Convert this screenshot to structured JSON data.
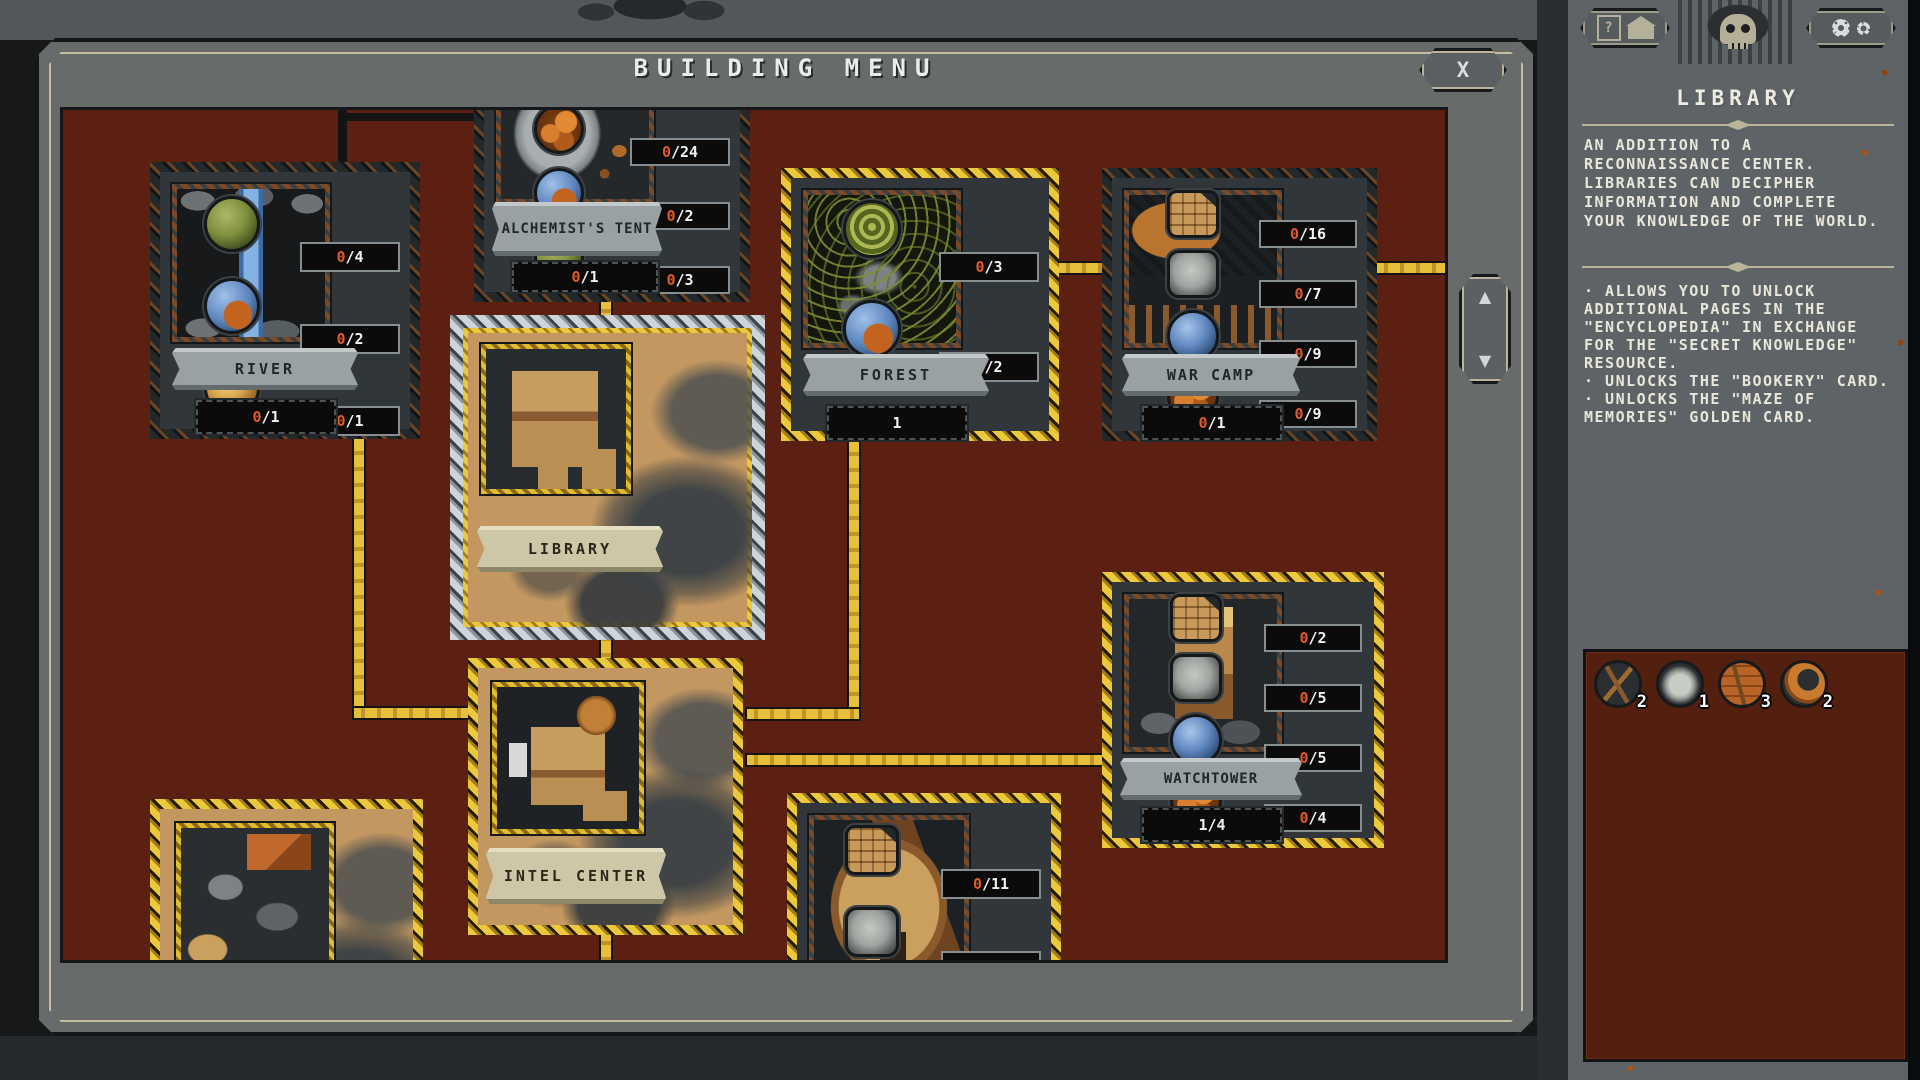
{
  "window": {
    "title": "BUILDING MENU",
    "close_icon": "X",
    "scroll_up_icon": "▲",
    "scroll_down_icon": "▼"
  },
  "cards": [
    {
      "name": "RIVER",
      "count": {
        "cur": "0",
        "rest": "/1",
        "cur_style": "color:#e2592a"
      },
      "resources": [
        {
          "icon": "moss-sphere",
          "cur": "0",
          "rest": "/4",
          "cur_style": "color:#e2592a"
        },
        {
          "icon": "swirl-sphere",
          "cur": "0",
          "rest": "/2",
          "cur_style": "color:#e2592a"
        },
        {
          "icon": "amber-sphere",
          "cur": "0",
          "rest": "/1",
          "cur_style": "color:#e2592a"
        }
      ]
    },
    {
      "name": "ALCHEMIST'S TENT",
      "count": {
        "cur": "0",
        "rest": "/1",
        "cur_style": "color:#e2592a"
      },
      "resources": [
        {
          "icon": "clay-pots",
          "cur": "0",
          "rest": "/24",
          "cur_style": "color:#e2592a"
        },
        {
          "icon": "swirl-sphere",
          "cur": "0",
          "rest": "/2",
          "cur_style": "color:#e2592a"
        },
        {
          "icon": "moss-sphere",
          "cur": "0",
          "rest": "/3",
          "cur_style": "color:#e2592a"
        }
      ]
    },
    {
      "name": "FOREST",
      "count": {
        "cur": "1",
        "rest": "",
        "cur_style": "color:#f2f2f2"
      },
      "resources": [
        {
          "icon": "green-spiral",
          "cur": "0",
          "rest": "/3",
          "cur_style": "color:#e2592a"
        },
        {
          "icon": "swirl-sphere",
          "cur": "0",
          "rest": "/2",
          "cur_style": "color:#e2592a"
        }
      ]
    },
    {
      "name": "WAR CAMP",
      "count": {
        "cur": "0",
        "rest": "/1",
        "cur_style": "color:#e2592a"
      },
      "resources": [
        {
          "icon": "wood-planks",
          "cur": "0",
          "rest": "/16",
          "cur_style": "color:#e2592a"
        },
        {
          "icon": "stone-block",
          "cur": "0",
          "rest": "/7",
          "cur_style": "color:#e2592a"
        },
        {
          "icon": "blue-sphere",
          "cur": "0",
          "rest": "/9",
          "cur_style": "color:#e2592a"
        },
        {
          "icon": "clay-pots",
          "cur": "0",
          "rest": "/9",
          "cur_style": "color:#e2592a"
        }
      ]
    },
    {
      "name": "LIBRARY",
      "state": "selected"
    },
    {
      "name": "INTEL CENTER",
      "state": "built"
    },
    {
      "name": "WATCHTOWER",
      "count": {
        "cur": "1",
        "rest": "/4",
        "cur_style": "color:#f2f2f2"
      },
      "resources": [
        {
          "icon": "wood-planks",
          "cur": "0",
          "rest": "/2",
          "cur_style": "color:#e2592a"
        },
        {
          "icon": "stone-block",
          "cur": "0",
          "rest": "/5",
          "cur_style": "color:#e2592a"
        },
        {
          "icon": "blue-sphere",
          "cur": "0",
          "rest": "/5",
          "cur_style": "color:#e2592a"
        },
        {
          "icon": "clay-pots",
          "cur": "0",
          "rest": "/4",
          "cur_style": "color:#e2592a"
        }
      ]
    },
    {
      "name": "",
      "state": "built-partial"
    },
    {
      "name": "",
      "resources": [
        {
          "icon": "wood-planks",
          "cur": "0",
          "rest": "/11",
          "cur_style": "color:#e2592a"
        },
        {
          "icon": "stone-block",
          "cur": "0",
          "rest": "/2",
          "cur_style": "color:#e2592a"
        },
        {
          "icon": "blue-sphere"
        }
      ]
    }
  ],
  "sidebar": {
    "help_button": {
      "question_glyph": "?",
      "icons": [
        "question-mark",
        "house"
      ]
    },
    "settings_button": {
      "icons": [
        "gear-large",
        "gear-small"
      ]
    },
    "emblem_icon": "winged-skull",
    "title": "LIBRARY",
    "description": "AN ADDITION TO A RECONNAISSANCE CENTER. LIBRARIES CAN DECIPHER INFORMATION AND COMPLETE YOUR KNOWLEDGE OF THE WORLD.",
    "bullets": [
      "· ALLOWS YOU TO UNLOCK ADDITIONAL PAGES IN THE \"ENCYCLOPEDIA\" IN EXCHANGE FOR THE \"SECRET KNOWLEDGE\" RESOURCE.",
      "· UNLOCKS THE \"BOOKERY\" CARD.",
      "· UNLOCKS THE \"MAZE OF MEMORIES\" GOLDEN CARD."
    ],
    "resources": [
      {
        "icon": "branches",
        "count": "2"
      },
      {
        "icon": "stone",
        "count": "1"
      },
      {
        "icon": "bricks",
        "count": "3"
      },
      {
        "icon": "horn",
        "count": "2"
      }
    ]
  },
  "colors": {
    "gold_accent": "#e7c23c",
    "silver_selected": "#c6ced3",
    "content_red": "#5c2013",
    "frame_grey": "#676c6a",
    "counter_zero": "#e2592a",
    "counter_text": "#f2f2f2"
  }
}
